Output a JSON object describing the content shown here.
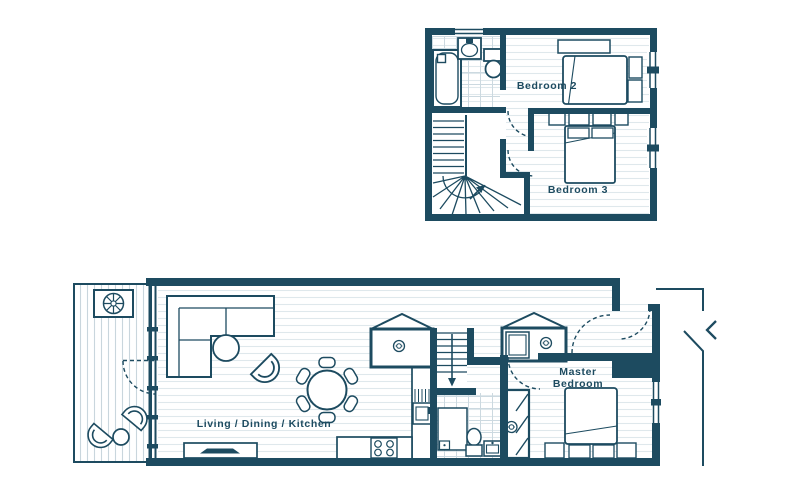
{
  "palette": {
    "ink": "#1d4b60",
    "floor_hatch": "#dfe8ec",
    "tile_line": "#ccd9e0",
    "deck_line": "#c9d6dd",
    "background": "#ffffff"
  },
  "upper_floor": {
    "labels": {
      "bedroom_2": "Bedroom 2",
      "bedroom_3": "Bedroom 3"
    },
    "icons": [
      "bathtub-icon",
      "basin-icon",
      "toilet-icon",
      "staircase-icon",
      "stair-direction-arrow-icon",
      "double-bed-icon",
      "pillow-icon",
      "bedside-table-icon",
      "window-icon",
      "door-swing-icon",
      "shelf-icon"
    ]
  },
  "ground_floor": {
    "labels": {
      "living_dining_kitchen": "Living / Dining / Kitchen",
      "master_bedroom_lines": [
        "Master",
        "Bedroom"
      ]
    },
    "icons": [
      "terrace-planter-icon",
      "terrace-chair-icon",
      "terrace-table-icon",
      "sliding-door-icon",
      "corner-sofa-icon",
      "coffee-table-icon",
      "armchair-icon",
      "dining-table-icon",
      "dining-chair-icon",
      "tv-sideboard-icon",
      "kitchen-counter-icon",
      "kitchen-sink-icon",
      "hob-icon",
      "storage-cupboard-icon",
      "washing-machine-icon",
      "appliance-tag-icon",
      "staircase-icon",
      "shower-icon",
      "toilet-icon",
      "basin-icon",
      "wardrobe-icon",
      "double-bed-icon",
      "entry-door-swing-icon",
      "entrance-chevron-icon"
    ]
  }
}
